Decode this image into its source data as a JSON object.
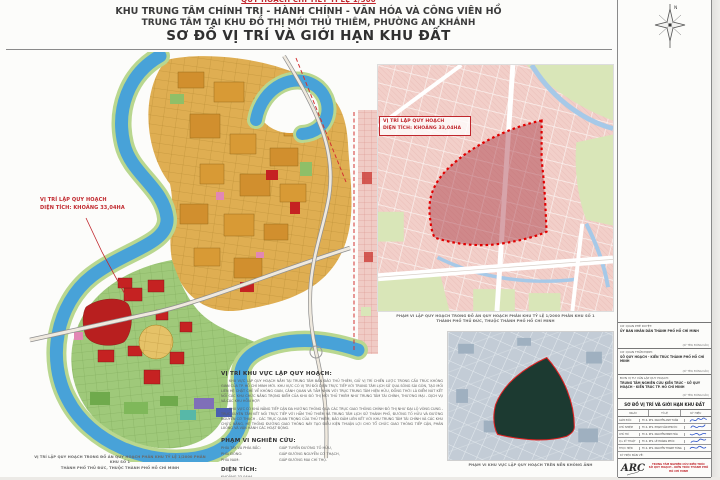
{
  "colors": {
    "accent_red": "#c0272d",
    "river_blue": "#48a2d8",
    "parcel_tan": "#dfae52",
    "zoning_salmon": "#f2cfc9",
    "boundary_red": "#e10000",
    "aerial_green": "#1c3a31",
    "signature_blue": "#2a52c8"
  },
  "header": {
    "line1": "QUY HOẠCH CHI TIẾT TỈ LỆ 1/500",
    "line2": "KHU TRUNG TÂM CHÍNH TRỊ - HÀNH CHÍNH - VĂN HÓA VÀ CÔNG VIÊN HỒ",
    "line3": "TRUNG TÂM TẠI KHU ĐÔ THỊ MỚI THỦ THIÊM, PHƯỜNG AN KHÁNH",
    "line4": "SƠ ĐỒ VỊ TRÍ VÀ GIỚI HẠN KHU ĐẤT"
  },
  "left_map": {
    "label": {
      "line1": "VỊ TRÍ LẬP QUY HOẠCH",
      "line2": "DIỆN TÍCH: KHOẢNG 33,04HA"
    },
    "caption1": "VỊ TRÍ LẬP QUY HOẠCH TRONG ĐỒ ÁN QUY HOẠCH PHÂN KHU TỶ LỆ 1/2000 PHÂN KHU SỐ 1",
    "caption2": "THÀNH PHỐ THỦ ĐỨC, THUỘC THÀNH PHỐ HỒ CHÍ MINH"
  },
  "right_map": {
    "label": {
      "line1": "VỊ TRÍ LẬP QUY HOẠCH",
      "line2": "DIỆN TÍCH: KHOẢNG 33,04HA"
    },
    "caption1": "PHẠM VI LẬP QUY HOẠCH TRONG ĐỒ ÁN QUY HOẠCH PHÂN KHU TỶ LỆ 1/2000 PHÂN KHU SỐ 1",
    "caption2": "THÀNH PHỐ THỦ ĐỨC, THUỘC THÀNH PHỐ HỒ CHÍ MINH"
  },
  "aerial": {
    "caption": "PHẠM VI KHU VỰC LẬP QUY HOẠCH TRÊN NỀN KHÔNG ẢNH"
  },
  "notes": {
    "location_heading": "VỊ TRÍ KHU VỰC LẬP QUY HOẠCH:",
    "para1": "KHU VỰC LẬP QUY HOẠCH NẰM TẠI TRUNG TÂM BÁN ĐẢO THỦ THIÊM, GIỮ VỊ TRÍ CHIẾN LƯỢC TRONG CẤU TRÚC KHÔNG GIAN CỦA TP. HỒ CHÍ MINH MỚI. KHU VỰC CÓ VỊ TRÍ ĐỐI DIỆN TRỰC TIẾP VỚI TRUNG TÂM LỊCH SỬ QUA SÔNG SÀI GÒN, TẠO MỐI LIÊN HỆ CHẶT CHẼ VỀ KHÔNG GIAN, CẢNH QUAN VÀ TẦM NHÌN VỚI TRỤC TRUNG TÂM HIỆN HỮU, ĐỒNG THỜI LÀ ĐIỂM NÚT KẾT NỐI CÁC KHU CHỨC NĂNG TRỌNG ĐIỂM CỦA KHU ĐÔ THỊ MỚI THỦ THIÊM NHƯ TRUNG TÂM TÀI CHÍNH, THƯƠNG MẠI - DỊCH VỤ VÀ CÁC KHU HỖN HỢP.",
    "para2": "KHU VỰC CÓ KHẢ NĂNG TIẾP CẬN ĐA HƯỚNG THÔNG QUA CÁC TRỤC GIAO THÔNG CHÍNH ĐÔ THỊ NHƯ ĐẠI LỘ VÒNG CUNG - TRỤC XUYÊN TÂM KẾT NỐI TRỰC TIẾP VỚI HẦM THỦ THIÊM VÀ TRUNG TÂM LỊCH SỬ THÀNH PHỐ, ĐƯỜNG TỐ HỮU VÀ ĐƯỜNG NGUYỄN CƠ THẠCH - CÁC TRỤC QUAN TRỌNG CỦA THỦ THIÊM, BẢO ĐẢM LIÊN KẾT VỚI KHU TRUNG TÂM TÀI CHÍNH VÀ CÁC KHU CHỨC NĂNG. HỆ THỐNG ĐƯỜNG GIAO THÔNG NÀY TẠO ĐIỀU KIỆN THUẬN LỢI CHO TỔ CHỨC GIAO THÔNG TIẾP CẬN, PHÂN LUỒNG VÀ VẬN HÀNH CÁC HOẠT ĐỘNG.",
    "scope_heading": "PHẠM VI NGHIÊN CỨU:",
    "scope": [
      {
        "label": "PHÍA TÂY VÀ PHÍA BẮC:",
        "value": "GIÁP TUYẾN ĐƯỜNG TỐ HỮU,"
      },
      {
        "label": "PHÍA ĐÔNG:",
        "value": "GIÁP ĐƯỜNG NGUYỄN CƠ THẠCH,"
      },
      {
        "label": "PHÍA NAM:",
        "value": "GIÁP ĐƯỜNG MAI CHÍ THỌ."
      }
    ],
    "area_heading": "DIỆN TÍCH:",
    "area_value": "KHOẢNG 33,04HA."
  },
  "title_block": {
    "sections": [
      {
        "label": "CƠ QUAN PHÊ DUYỆT:",
        "name": "ỦY BAN NHÂN DÂN THÀNH PHỐ HỒ CHÍ MINH",
        "sign_note": "(KÝ TÊN, ĐÓNG DẤU)"
      },
      {
        "label": "CƠ QUAN THẨM ĐỊNH:",
        "name": "SỞ QUY HOẠCH - KIẾN TRÚC THÀNH PHỐ HỒ CHÍ MINH",
        "sign_note": "(KÝ TÊN, ĐÓNG DẤU)"
      },
      {
        "label": "ĐƠN VỊ TƯ VẤN LẬP QUY HOẠCH:",
        "name": "TRUNG TÂM NGHIÊN CỨU KIẾN TRÚC - SỞ QUY HOẠCH - KIẾN TRÚC TP. HỒ CHÍ MINH",
        "sign_note": "(KÝ TÊN, ĐÓNG DẤU)"
      }
    ],
    "sheet_name": "SƠ ĐỒ VỊ TRÍ VÀ GIỚI HẠN KHU ĐẤT",
    "meta_cols": [
      "NGÀY",
      "TỈ LỆ",
      "KÝ HIỆU"
    ],
    "signatures": [
      {
        "role": "GIÁM ĐỐC",
        "name": "Th.S. KTS. NGUYỄN ANH TUẤN"
      },
      {
        "role": "CHỦ NHIỆM",
        "name": "Th.S. KTS. PHẠM VĂN PHƯỚC"
      },
      {
        "role": "CHỦ TRÌ",
        "name": "Th.S. KTS. NGUYỄN MINH HÒA"
      },
      {
        "role": "Q.L KỸ THUẬT",
        "name": "Th.S. KTS. LÊ HOÀNG PHÚC"
      },
      {
        "role": "THỰC HIỆN",
        "name": "Th.S. KTS. NGUYỄN THANH TÙNG"
      }
    ],
    "code_label": "KÝ HIỆU BẢN VẼ:"
  },
  "firm": {
    "logo": "ARC",
    "line1": "TRUNG TÂM NGHIÊN CỨU KIẾN TRÚC",
    "line2": "SỞ QUY HOẠCH - KIẾN TRÚC THÀNH PHỐ HỒ CHÍ MINH"
  }
}
